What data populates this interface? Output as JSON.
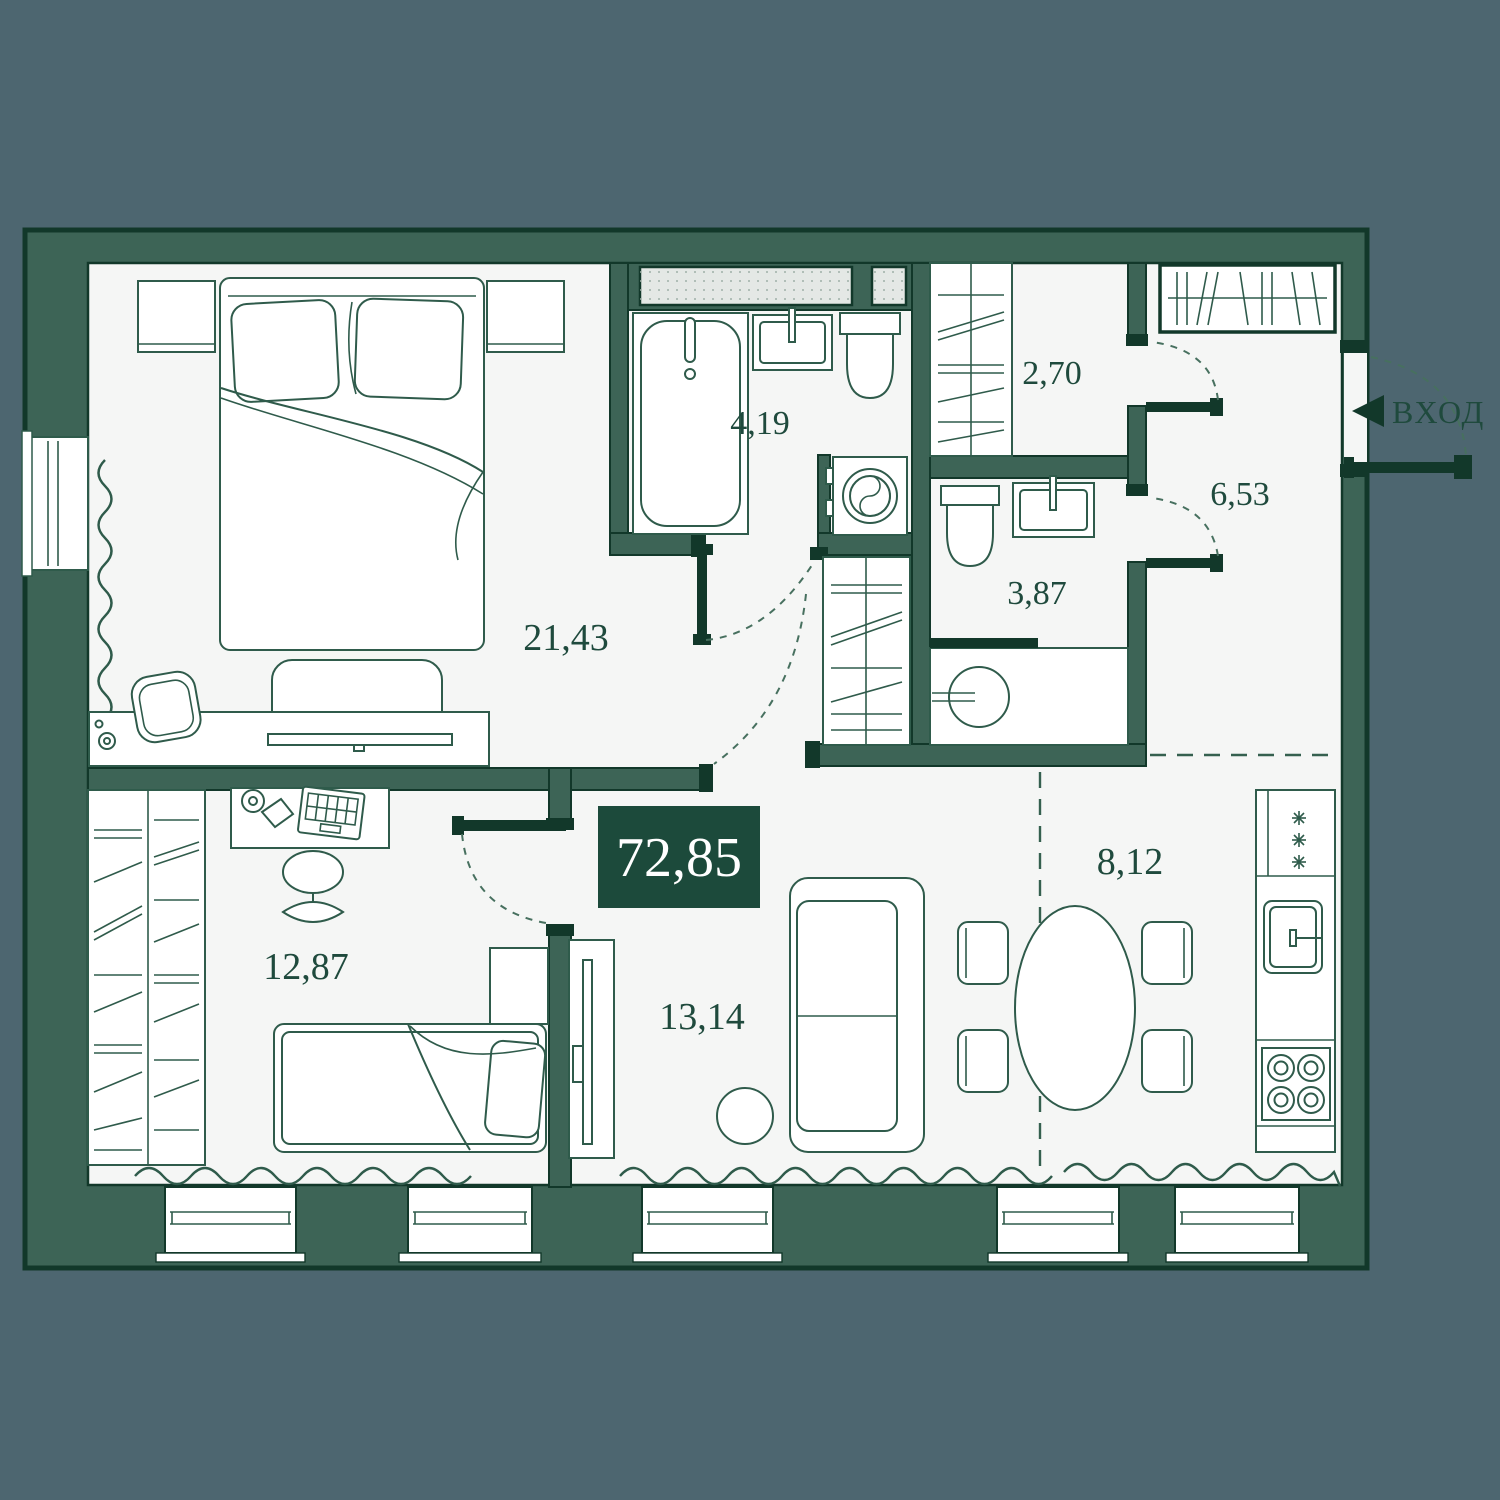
{
  "floor_plan": {
    "total_area": "72,85",
    "entrance_label": "ВХОД",
    "rooms": [
      {
        "name": "master-bedroom",
        "area": "21,43"
      },
      {
        "name": "bathroom",
        "area": "4,19"
      },
      {
        "name": "walk-in-closet",
        "area": "2,70"
      },
      {
        "name": "hallway",
        "area": "6,53"
      },
      {
        "name": "shower-room",
        "area": "3,87"
      },
      {
        "name": "second-bedroom",
        "area": "12,87"
      },
      {
        "name": "living-room",
        "area": "13,14"
      },
      {
        "name": "kitchen",
        "area": "8,12"
      }
    ],
    "colors": {
      "background": "#4D6670",
      "wall_fill": "#3D6456",
      "wall_outline": "#12382A",
      "floor": "#F5F6F5",
      "furniture_line": "#2F5B4B",
      "label_text": "#1F4A3D",
      "badge_background": "#1C4A3B",
      "badge_text": "#FFFFFF",
      "vent_shaft_fill": "#E4E8E5"
    }
  }
}
